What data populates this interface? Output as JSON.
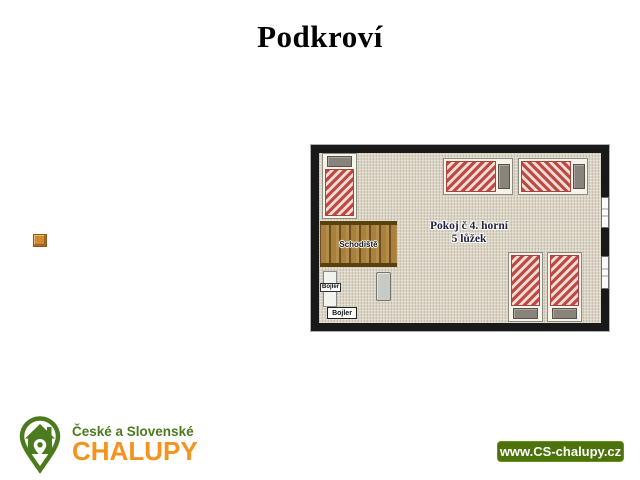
{
  "page": {
    "title": "Podkroví",
    "background": "#ffffff"
  },
  "floorplan": {
    "room": {
      "line1": "Pokoj č 4. horní",
      "line2": "5 lůžek"
    },
    "stairs_label": "Schodiště",
    "boiler_upper_label": "Bojler",
    "boiler_lower_label": "Bojler",
    "beds_count": 5,
    "windows_count": 2,
    "colors": {
      "wall": "#191919",
      "floor": "#d8d1c0",
      "bed_stripe_red": "#bd4a45",
      "bed_stripe_light": "#f2ddd5",
      "bed_frame": "#f6f3ea",
      "pillow_gray": "#8a837c",
      "stairs_wood": "#a8813e",
      "stairs_rail": "#58400f"
    }
  },
  "icons": {
    "logo_icon": "house-location-pin-icon",
    "misc_icon": "wood-swatch-icon"
  },
  "branding": {
    "line1": "České a Slovenské",
    "line2": "CHALUPY",
    "green": "#4c7a1e",
    "orange": "#f6921e"
  },
  "badge": {
    "text": "www.CS-chalupy.cz",
    "bg": "#4c720b"
  }
}
